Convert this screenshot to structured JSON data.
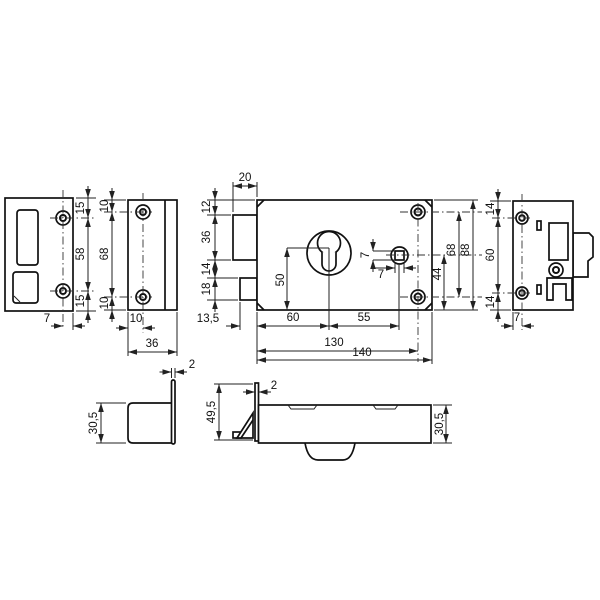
{
  "views": {
    "strike_plate_front": {
      "edge_to_hole_top": "15",
      "hole_spacing": "58",
      "edge_to_hole_bottom": "15",
      "hole_to_edge": "7"
    },
    "faceplate_front": {
      "edge_to_hole_top": "10",
      "hole_spacing": "68",
      "edge_to_hole_bottom": "10",
      "edge_to_hole_axis": "10",
      "width": "36"
    },
    "lock_body_front": {
      "latch_width": "20",
      "top_to_latch": "12",
      "latch_height": "36",
      "latch_to_bolt": "14",
      "bolt_height": "18",
      "bolt_throw": "13,5",
      "backset": "60",
      "cylinder_to_spindle": "55",
      "length_to_hole_axis": "130",
      "total_length": "140",
      "cylinder_to_bottom": "50",
      "spindle_square_height": "7",
      "spindle_square_width": "7",
      "spindle_to_bottom": "44",
      "hole_spacing": "68",
      "total_height": "88"
    },
    "lock_body_side": {
      "edge_to_hole_top": "14",
      "hole_spacing": "60",
      "edge_to_hole_bottom": "14",
      "hole_to_edge": "7"
    },
    "strike_plate_bottom": {
      "plate_thickness": "2",
      "box_depth": "30,5"
    },
    "lock_body_bottom": {
      "faceplate_width": "49,5",
      "faceplate_thickness": "2",
      "case_depth": "30,5"
    }
  }
}
